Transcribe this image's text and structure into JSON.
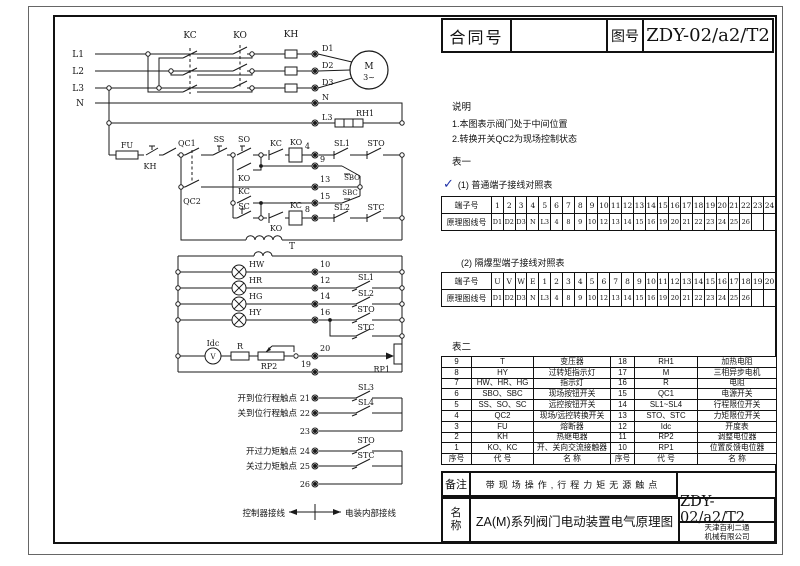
{
  "colors": {
    "line": "#1a1a1a",
    "check_mark": "#2233a8",
    "paper": "#ffffff"
  },
  "title_block": {
    "contract_label": "合同号",
    "contract_value": "",
    "drawing_no_label": "图号",
    "drawing_no_value": "ZDY-02/a2/T2"
  },
  "notes": {
    "heading": "说明",
    "items": [
      "1.本图表示阀门处于中间位置",
      "2.转换开关QC2为现场控制状态"
    ]
  },
  "table1": {
    "heading": "表一",
    "check": "✓",
    "sub1_label": "(1)    普通端子接线对照表",
    "sub2_label": "(2)    隔爆型端子接线对照表",
    "row_label1": "端子号",
    "row_label2": "原理图线号",
    "t1_row1": [
      "1",
      "2",
      "3",
      "4",
      "5",
      "6",
      "7",
      "8",
      "9",
      "10",
      "11",
      "12",
      "13",
      "14",
      "15",
      "16",
      "17",
      "18",
      "19",
      "20",
      "21",
      "22",
      "23",
      "24"
    ],
    "t1_row2": [
      "D1",
      "D2",
      "D3",
      "N",
      "L3",
      "4",
      "8",
      "9",
      "10",
      "12",
      "13",
      "14",
      "15",
      "16",
      "19",
      "20",
      "21",
      "22",
      "23",
      "24",
      "25",
      "26",
      "",
      ""
    ],
    "t2_row1": [
      "U",
      "V",
      "W",
      "E",
      "1",
      "2",
      "3",
      "4",
      "5",
      "6",
      "7",
      "8",
      "9",
      "10",
      "11",
      "12",
      "13",
      "14",
      "15",
      "16",
      "17",
      "18",
      "19",
      "20"
    ],
    "t2_row2": [
      "D1",
      "D2",
      "D3",
      "N",
      "L3",
      "4",
      "8",
      "9",
      "10",
      "12",
      "13",
      "14",
      "15",
      "16",
      "19",
      "20",
      "21",
      "22",
      "23",
      "24",
      "25",
      "26",
      "",
      ""
    ]
  },
  "table2": {
    "heading": "表二",
    "rows": [
      [
        "9",
        "T",
        "变压器",
        "18",
        "RH1",
        "加热电阻"
      ],
      [
        "8",
        "HY",
        "过转矩指示灯",
        "17",
        "M",
        "三相异步电机"
      ],
      [
        "7",
        "HW、HR、HG",
        "指示灯",
        "16",
        "R",
        "电阻"
      ],
      [
        "6",
        "SBO、SBC",
        "现场按钮开关",
        "15",
        "QC1",
        "电源开关"
      ],
      [
        "5",
        "SS、SO、SC",
        "远控按钮开关",
        "14",
        "SL1~SL4",
        "行程限位开关"
      ],
      [
        "4",
        "QC2",
        "现场/远控转换开关",
        "13",
        "STO、STC",
        "力矩限位开关"
      ],
      [
        "3",
        "FU",
        "熔断器",
        "12",
        "Idc",
        "开度表"
      ],
      [
        "2",
        "KH",
        "热继电器",
        "11",
        "RP2",
        "调整电位器"
      ],
      [
        "1",
        "KO、KC",
        "开、关向交流接触器",
        "10",
        "RP1",
        "位置反馈电位器"
      ],
      [
        "序号",
        "代  号",
        "名  称",
        "序号",
        "代  号",
        "名  称"
      ]
    ]
  },
  "remark": {
    "label": "备注",
    "text": "带现场操作,行程力矩无源触点"
  },
  "name_block": {
    "label1": "名",
    "label2": "称",
    "name": "ZA(M)系列阀门电动装置电气原理图",
    "drawing_no": "ZDY-02/a2/T2",
    "company1": "天津百利二通",
    "company2": "机械有限公司"
  },
  "schematic": {
    "labels": {
      "l1": "L1",
      "l2": "L2",
      "l3": "L3",
      "n": "N",
      "kc": "KC",
      "ko": "KO",
      "kh": "KH",
      "d1": "D1",
      "d2": "D2",
      "d3": "D3",
      "n_t": "N",
      "l3_t": "L3",
      "rh1": "RH1",
      "m": "M",
      "m3": "3~",
      "fu": "FU",
      "kh2": "KH",
      "qc1": "QC1",
      "qc2": "QC2",
      "ss": "SS",
      "so": "SO",
      "sc": "SC",
      "ko_hold": "KO",
      "kc_hold": "KC",
      "kc_nc": "KC",
      "ko_coil": "KO",
      "ko_nc": "KO",
      "kc_coil": "KC",
      "t": "T",
      "n4": "4",
      "n9": "9",
      "n13": "13",
      "n15": "15",
      "n8": "8",
      "sl1a": "SL1",
      "stoa": "STO",
      "sbo": "SBO",
      "sbc": "SBC",
      "sl2a": "SL2",
      "stca": "STC",
      "hw": "HW",
      "hr": "HR",
      "hg": "HG",
      "hy": "HY",
      "n10": "10",
      "n12": "12",
      "n14": "14",
      "n16": "16",
      "n20": "20",
      "n19": "19",
      "sl1b": "SL1",
      "sl2b": "SL2",
      "stob": "STO",
      "stcb": "STC",
      "idc": "Idc",
      "vm": "V",
      "r": "R",
      "rp2": "RP2",
      "rp1": "RP1",
      "c21": "开到位行程触点",
      "c22": "关到位行程触点",
      "c24": "开过力矩触点",
      "c25": "关过力矩触点",
      "n21": "21",
      "n22": "22",
      "n23": "23",
      "n24": "24",
      "n25": "25",
      "n26": "26",
      "sl3": "SL3",
      "sl4": "SL4",
      "stoc": "STO",
      "stcc": "STC",
      "leg_l": "控制器接线",
      "leg_r": "电装内部接线"
    }
  }
}
